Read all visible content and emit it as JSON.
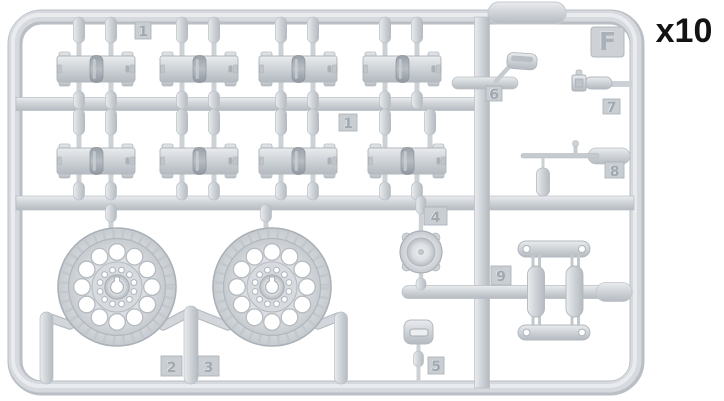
{
  "diagram": {
    "quantity_label": "x10",
    "sprue_letter": "F",
    "part_tabs": {
      "track_row_top": "1",
      "track_row_mid": "1",
      "wheel_post_left": "2",
      "wheel_post_right": "3",
      "hub_cap": "4",
      "hatch_plate": "5",
      "scoop": "6",
      "plug": "7",
      "tow_rod": "8",
      "suspension": "9"
    },
    "colors": {
      "background": "#ffffff",
      "plastic_base": "#d5d9dd",
      "plastic_highlight": "#eaecee",
      "plastic_shadow": "#aab1b8",
      "label_text": "#131313"
    }
  }
}
